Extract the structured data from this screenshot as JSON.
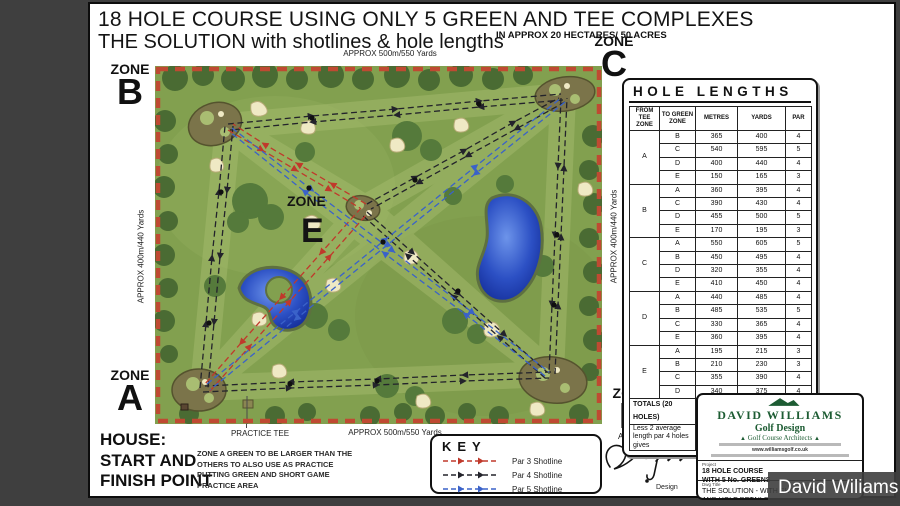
{
  "page": {
    "title_line1": "18 HOLE COURSE USING ONLY 5 GREEN AND TEE COMPLEXES",
    "title_line2": "THE SOLUTION with shotlines & hole lengths",
    "area_note": "IN APPROX 20 HECTARES/ 50 ACRES"
  },
  "zones": {
    "word": "ZONE",
    "a": "A",
    "b": "B",
    "c": "C",
    "d": "D",
    "e": "E"
  },
  "map": {
    "scale_top": "APPROX 500m/550 Yards",
    "scale_bottom": "APPROX 500m/550 Yards",
    "scale_left": "APPROX 400m/440 Yards",
    "scale_right": "APPROX 400m/440 Yards",
    "practice_tee": "PRACTICE TEE"
  },
  "house": {
    "lines": [
      "HOUSE:",
      "START AND",
      "FINISH POINT"
    ]
  },
  "notes": {
    "zone_a": "ZONE A GREEN TO BE LARGER THAN THE OTHERS TO ALSO USE AS PRACTICE PUTTING GREEN AND SHORT GAME PRACTICE AREA"
  },
  "key": {
    "title": "KEY",
    "items": [
      {
        "label": "Par 3 Shotline",
        "color": "#c0392b"
      },
      {
        "label": "Par 4 Shotline",
        "color": "#23232b"
      },
      {
        "label": "Par 5 Shotline",
        "color": "#3a62c9"
      }
    ]
  },
  "signature": {
    "initial": "A",
    "design_label": "Design"
  },
  "table": {
    "title": "HOLE LENGTHS",
    "headers": [
      "FROM TEE ZONE",
      "TO GREEN ZONE",
      "METRES",
      "YARDS",
      "PAR"
    ],
    "groups": [
      {
        "zone": "A",
        "rows": [
          [
            "B",
            365,
            400,
            4
          ],
          [
            "C",
            540,
            595,
            5
          ],
          [
            "D",
            400,
            440,
            4
          ],
          [
            "E",
            150,
            165,
            3
          ]
        ]
      },
      {
        "zone": "B",
        "rows": [
          [
            "A",
            360,
            395,
            4
          ],
          [
            "C",
            390,
            430,
            4
          ],
          [
            "D",
            455,
            500,
            5
          ],
          [
            "E",
            170,
            195,
            3
          ]
        ]
      },
      {
        "zone": "C",
        "rows": [
          [
            "A",
            550,
            605,
            5
          ],
          [
            "B",
            450,
            495,
            4
          ],
          [
            "D",
            320,
            355,
            4
          ],
          [
            "E",
            410,
            450,
            4
          ]
        ]
      },
      {
        "zone": "D",
        "rows": [
          [
            "A",
            440,
            485,
            4
          ],
          [
            "B",
            485,
            535,
            5
          ],
          [
            "C",
            330,
            365,
            4
          ],
          [
            "E",
            360,
            395,
            4
          ]
        ]
      },
      {
        "zone": "E",
        "rows": [
          [
            "A",
            195,
            215,
            3
          ],
          [
            "B",
            210,
            230,
            3
          ],
          [
            "C",
            355,
            390,
            4
          ],
          [
            "D",
            340,
            375,
            4
          ]
        ]
      }
    ],
    "totals": {
      "label": "TOTALS (20 HOLES)",
      "metres": "7,275",
      "yards": "8,015",
      "par": "80"
    },
    "adjusted": {
      "label": "Less 2 average length par 4 holes gives",
      "metres": "6,545",
      "yards": "7,215",
      "par": "72"
    }
  },
  "title_block": {
    "firm_name": "DAVID WILLIAMS",
    "firm_sub": "Golf Design",
    "firm_tag": "Golf Course Architects",
    "website": "www.williamsgolf.co.uk",
    "project_label": "Project",
    "project_line1": "18 HOLE COURSE",
    "project_line2": "WITH 5 No. GREENS",
    "dwg_title_label": "Dwg Title",
    "dwg_title_line1": "THE SOLUTION - WITH SHOTLINES",
    "dwg_title_line2": "AND HOLE DETAILS",
    "dwg_no_label": "Dwg No",
    "dwg_no": "4000/03",
    "scale_label": "Scale",
    "scale": "1:2000",
    "drawn_label": "Drawn",
    "drawn": "DW/JJ",
    "date_label": "Date",
    "date": "MAR 2010"
  },
  "watermark": {
    "text": "David Wiliams"
  }
}
